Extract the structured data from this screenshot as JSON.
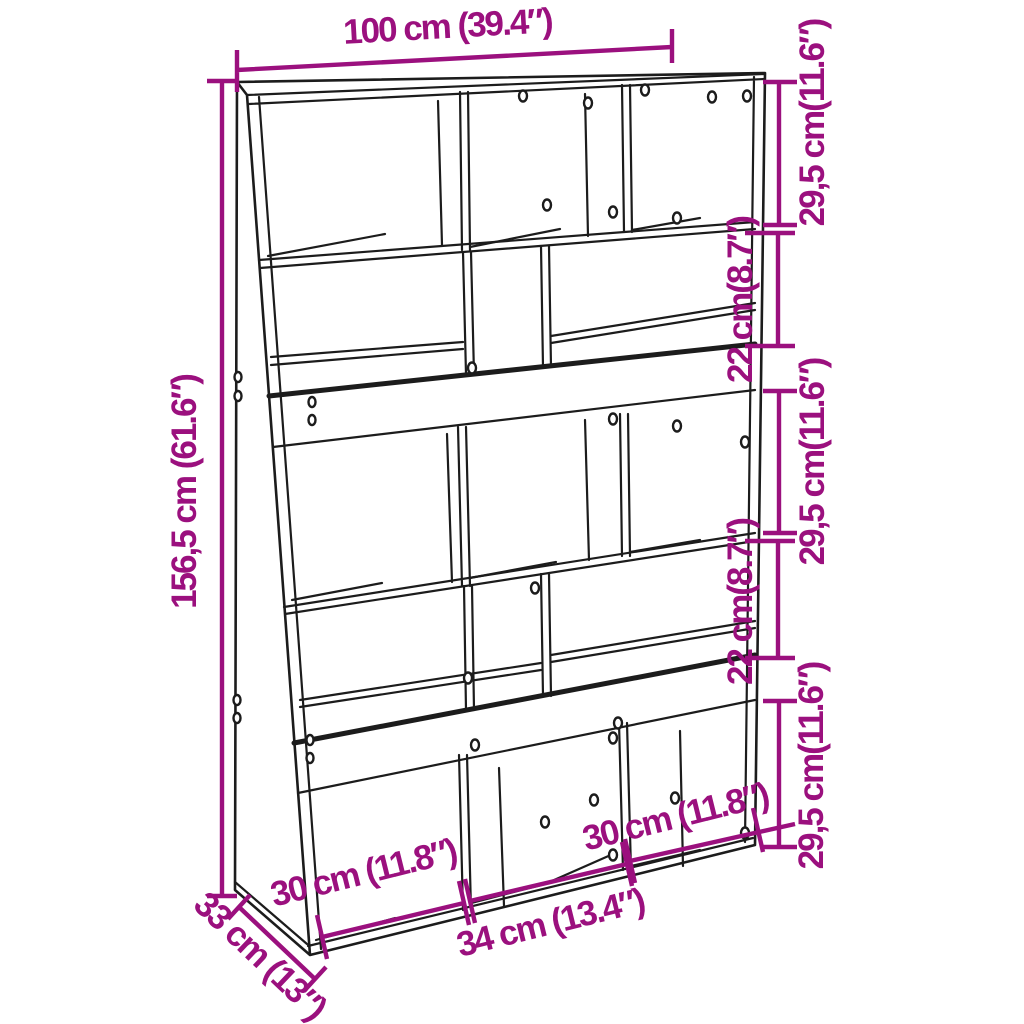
{
  "figure": {
    "kind": "furniture dimension diagram",
    "subject": "bookcase room divider line drawing"
  },
  "colors": {
    "dimension": "#9B107E",
    "line": "#1C1C1C",
    "background": "#FFFFFF"
  },
  "dimensions": {
    "width": {
      "label": "100 cm (39.4″)"
    },
    "height": {
      "label": "156,5 cm (61.6″)"
    },
    "depth": {
      "label": "33 cm (13″)"
    },
    "right_sections": [
      {
        "label": "29,5 cm(11.6″)"
      },
      {
        "label": "22 cm(8.7″)"
      },
      {
        "label": "29,5 cm(11.6″)"
      },
      {
        "label": "22 cm(8.7″)"
      },
      {
        "label": "29,5 cm(11.6″)"
      }
    ],
    "bottom_sections": [
      {
        "label": "30 cm (11.8″)"
      },
      {
        "label": "34 cm (13.4″)"
      },
      {
        "label": "30 cm (11.8″)"
      }
    ]
  }
}
